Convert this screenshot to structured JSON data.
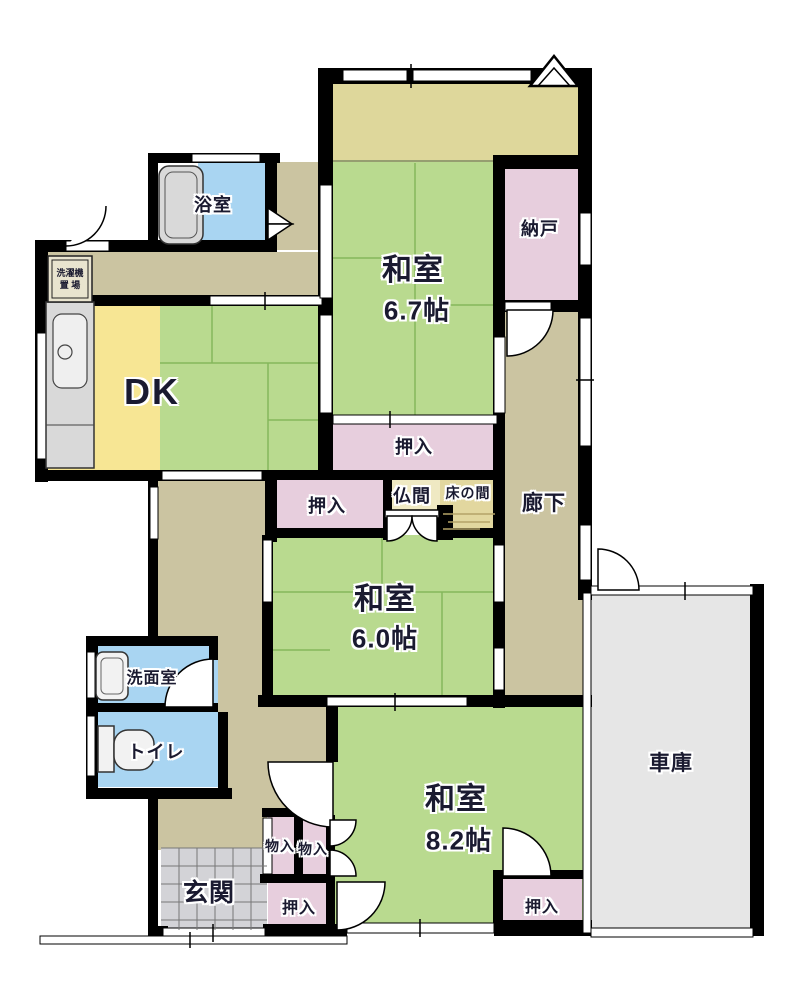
{
  "colors": {
    "wall": "#000000",
    "tatami_green": "#b9da8f",
    "tatami_line": "#85b75c",
    "corridor_tan": "#cbc4a1",
    "veranda_khaki": "#ded79b",
    "closet_pink": "#e7cedd",
    "kitchen_yellow": "#f7e694",
    "water_blue": "#a9d5f2",
    "fixture_gray": "#d9d9d9",
    "genkan_tile_gray": "#d3d3d7",
    "garage_gray": "#e6e6e6",
    "tokonoma_tan": "#e2d79f",
    "butsuma_cream": "#efe9c3",
    "label_navy": "#1a1a30"
  },
  "rooms": {
    "bath": {
      "label": "浴室"
    },
    "laundry": {
      "line1": "洗濯機",
      "line2": "置 場"
    },
    "dk": {
      "label": "DK"
    },
    "washitsu67": {
      "label": "和室",
      "size": "6.7帖"
    },
    "nando": {
      "label": "納戸"
    },
    "oshiire_top": {
      "label": "押入"
    },
    "oshiire_mid": {
      "label": "押入"
    },
    "butsuma": {
      "label": "仏間"
    },
    "tokonoma": {
      "label": "床の間"
    },
    "rouka": {
      "label": "廊下"
    },
    "washitsu60": {
      "label": "和室",
      "size": "6.0帖"
    },
    "senmenshitsu": {
      "label": "洗面室"
    },
    "toilet": {
      "label": "トイレ"
    },
    "genkan": {
      "label": "玄関"
    },
    "monoire_left": {
      "label": "物入"
    },
    "monoire_right": {
      "label": "物入"
    },
    "oshiire_center": {
      "label": "押入"
    },
    "washitsu82": {
      "label": "和室",
      "size": "8.2帖"
    },
    "oshiire_right": {
      "label": "押入"
    },
    "garage": {
      "label": "車庫"
    }
  }
}
